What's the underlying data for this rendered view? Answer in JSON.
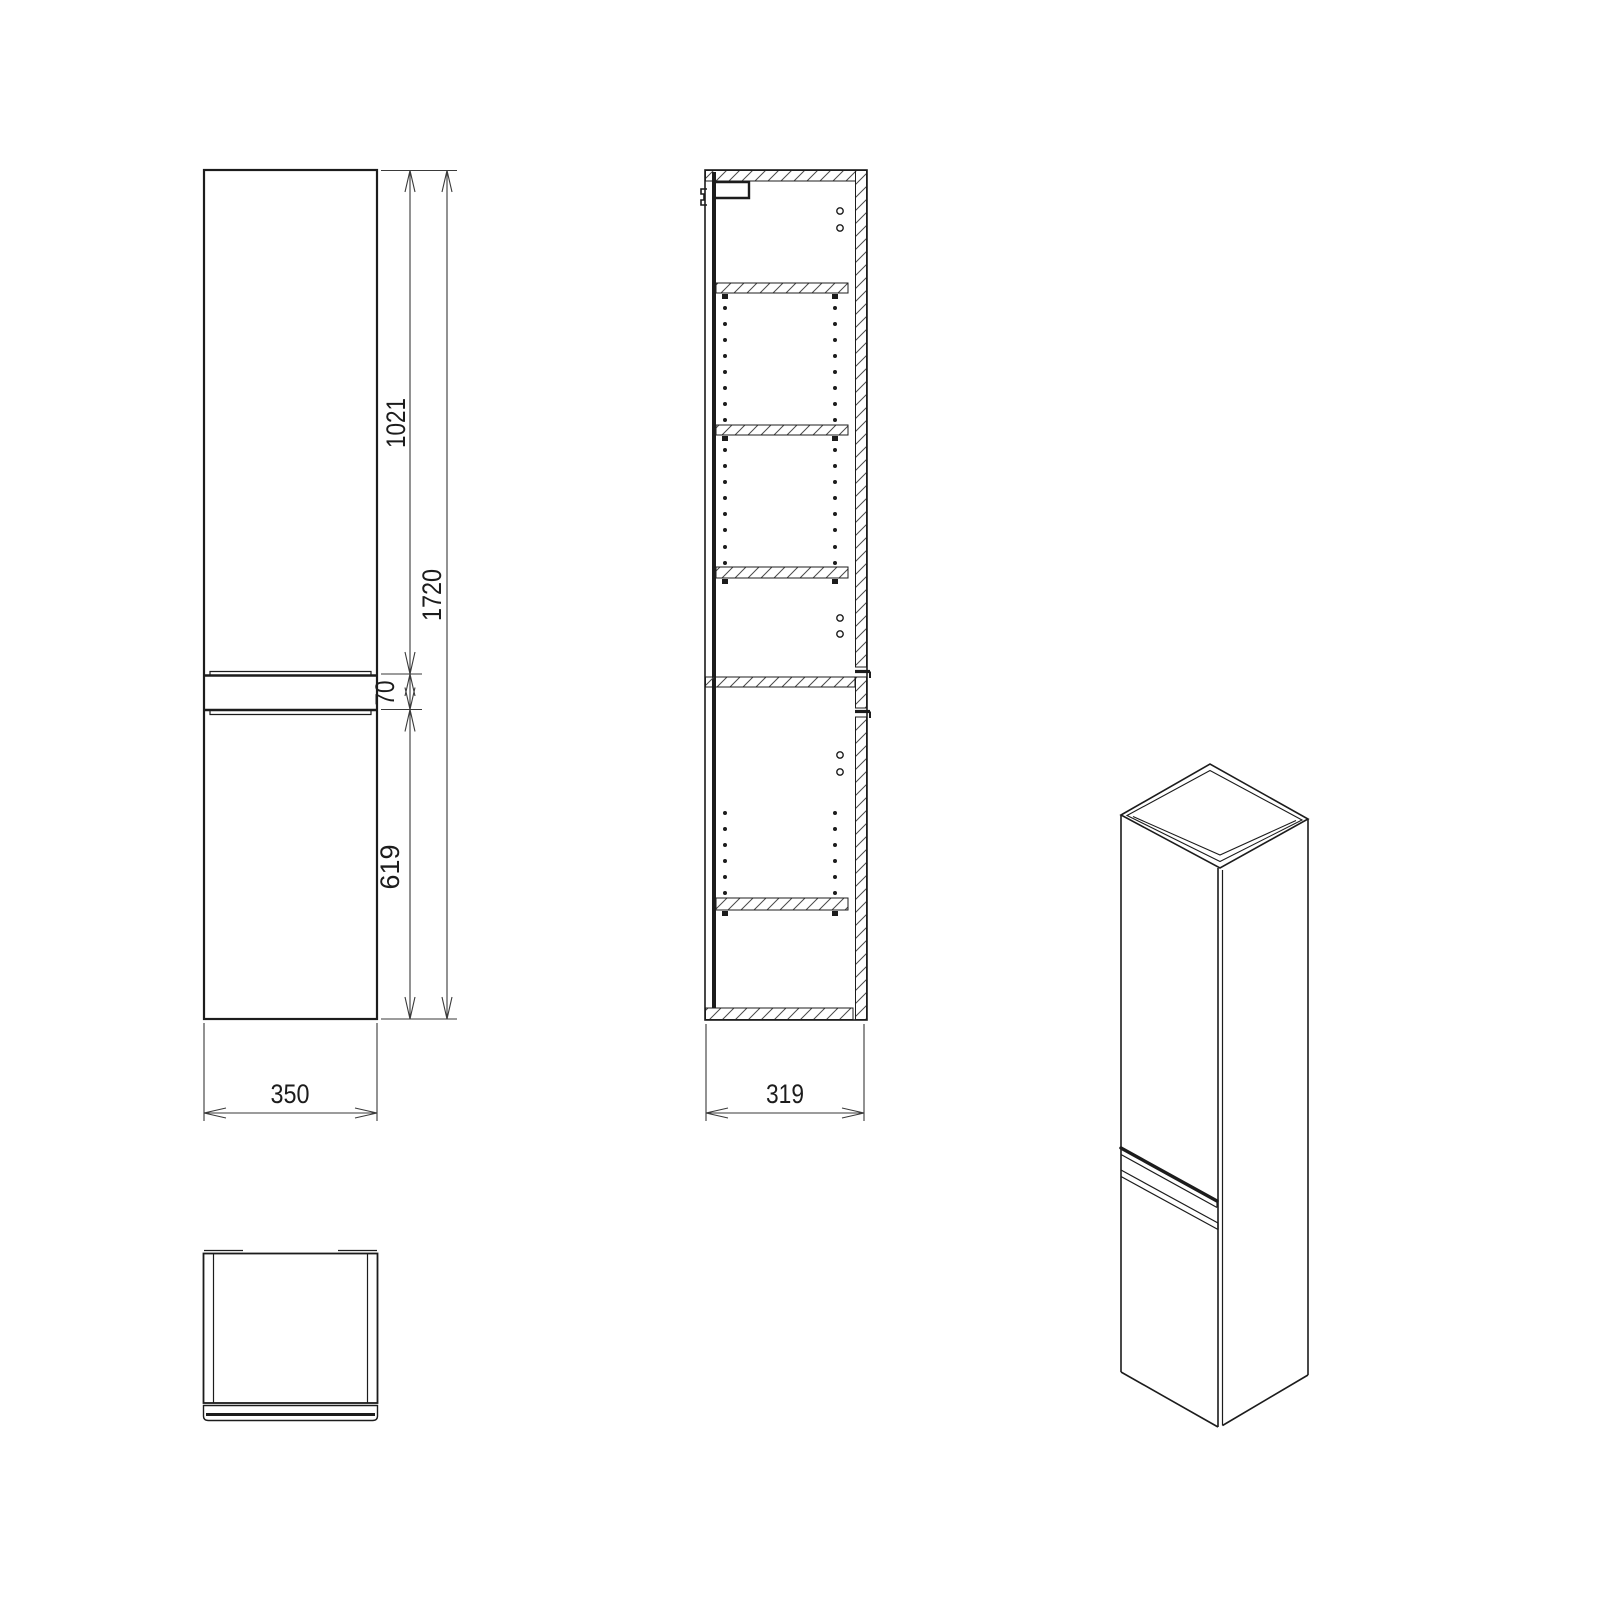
{
  "views": {
    "front": {
      "dims": {
        "upper_door_height": "1021",
        "total_height": "1720",
        "handle_gap": "70",
        "lower_door_height": "619",
        "width": "350"
      }
    },
    "section": {
      "dims": {
        "depth": "319"
      }
    }
  },
  "colors": {
    "line": "#1c1c1c",
    "dimension": "#3a3a3a",
    "hatch": "#4a4a4a",
    "background": "#ffffff"
  }
}
